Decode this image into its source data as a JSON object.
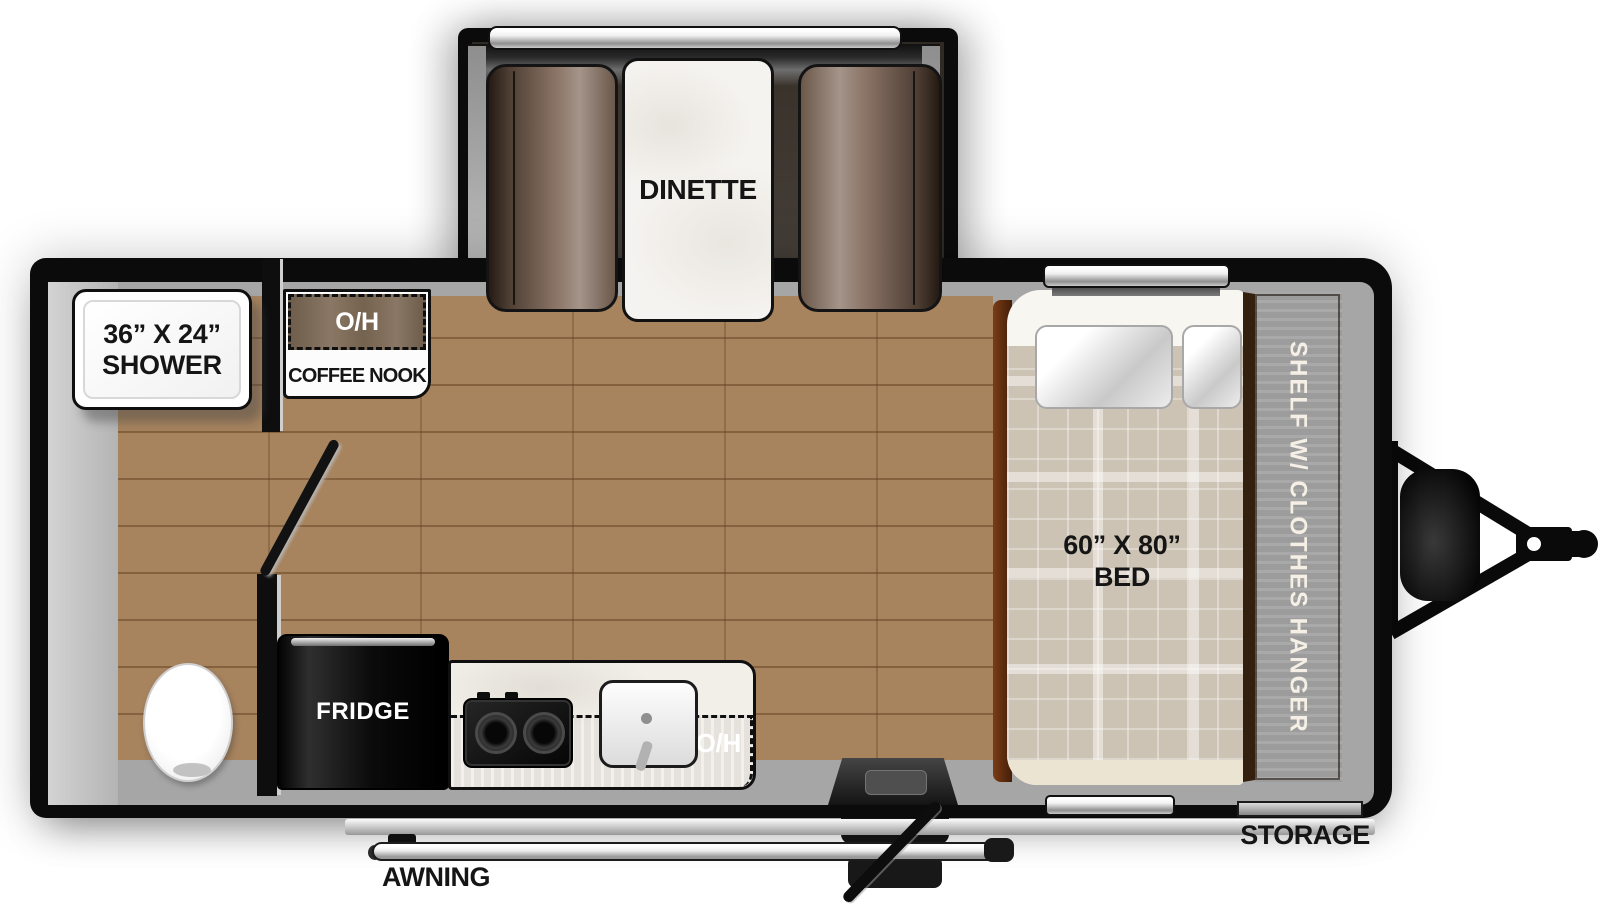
{
  "title": "Travel trailer floor plan",
  "labels": {
    "dinette": "DINETTE",
    "shower_size": "36” X 24”",
    "shower_name": "SHOWER",
    "coffee_nook_overhead": "O/H",
    "coffee_nook": "COFFEE NOOK",
    "fridge": "FRIDGE",
    "counter_overhead": "O/H",
    "bed_size": "60” X 80”",
    "bed_name": "BED",
    "shelf": "SHELF W/ CLOTHES HANGER",
    "storage": "STORAGE",
    "awning": "AWNING"
  },
  "colors": {
    "wall": "#0b0b0b",
    "wood_floor": "#a7835e",
    "interior_band": "#a6a6a6",
    "bench_brown": "#8d7769",
    "shelf_brown": "#5a3a1e",
    "nook_brown": "#7c6a58",
    "counter_tan": "#a09284",
    "blanket_beige": "#cdc3b4",
    "chrome": "#c9c9c9"
  }
}
